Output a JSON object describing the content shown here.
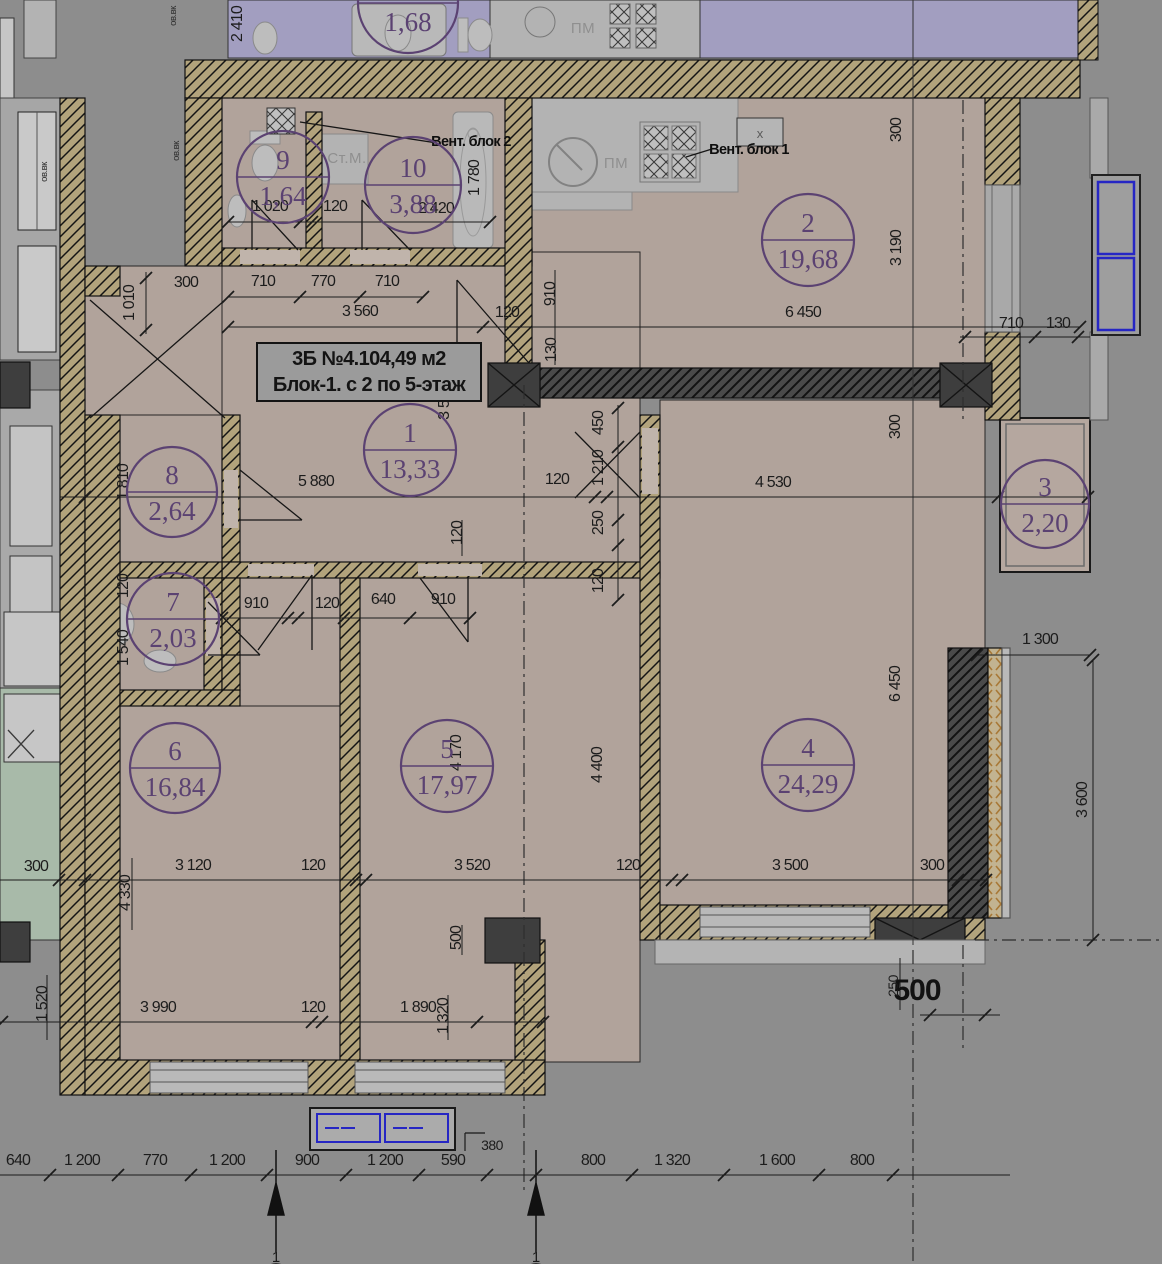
{
  "title": {
    "line1": "3Б №4.104,49 м2",
    "line2": "Блок-1. с 2 по 5-этаж"
  },
  "colors": {
    "background": "#8d8d8d",
    "floor": "#b1a39b",
    "wall_tan": "#b2a37c",
    "dark_wall": "#3e3e3e",
    "lavender": "#a29ec0",
    "kitchen_gray": "#b3b3b3",
    "green": "#a8baa9",
    "badge_purple": "#5b4272",
    "window_blue": "#2626c4",
    "insulation_orange": "#a87836"
  },
  "rooms": [
    {
      "num": "4",
      "area": "1,68",
      "cx": 408,
      "cy": 3,
      "r": 50
    },
    {
      "num": "9",
      "area": "1,64",
      "cx": 283,
      "cy": 177,
      "r": 46
    },
    {
      "num": "10",
      "area": "3,88",
      "cx": 413,
      "cy": 185,
      "r": 48
    },
    {
      "num": "2",
      "area": "19,68",
      "cx": 808,
      "cy": 240,
      "r": 46
    },
    {
      "num": "1",
      "area": "13,33",
      "cx": 410,
      "cy": 450,
      "r": 46
    },
    {
      "num": "8",
      "area": "2,64",
      "cx": 172,
      "cy": 492,
      "r": 45
    },
    {
      "num": "3",
      "area": "2,20",
      "cx": 1045,
      "cy": 504,
      "r": 44
    },
    {
      "num": "7",
      "area": "2,03",
      "cx": 173,
      "cy": 619,
      "r": 46
    },
    {
      "num": "6",
      "area": "16,84",
      "cx": 175,
      "cy": 768,
      "r": 45
    },
    {
      "num": "5",
      "area": "17,97",
      "cx": 447,
      "cy": 766,
      "r": 46
    },
    {
      "num": "4",
      "area": "24,29",
      "cx": 808,
      "cy": 765,
      "r": 46
    }
  ],
  "dims_h": [
    {
      "t": "1 020",
      "x": 270,
      "y": 211
    },
    {
      "t": "120",
      "x": 335,
      "y": 211
    },
    {
      "t": "2 420",
      "x": 436,
      "y": 213
    },
    {
      "t": "300",
      "x": 186,
      "y": 287
    },
    {
      "t": "710",
      "x": 263,
      "y": 286
    },
    {
      "t": "770",
      "x": 323,
      "y": 286
    },
    {
      "t": "710",
      "x": 387,
      "y": 286
    },
    {
      "t": "3 560",
      "x": 360,
      "y": 316
    },
    {
      "t": "120",
      "x": 507,
      "y": 317
    },
    {
      "t": "6 450",
      "x": 803,
      "y": 317
    },
    {
      "t": "710",
      "x": 1011,
      "y": 328
    },
    {
      "t": "130",
      "x": 1058,
      "y": 328
    },
    {
      "t": "5 880",
      "x": 316,
      "y": 486
    },
    {
      "t": "120",
      "x": 557,
      "y": 484
    },
    {
      "t": "4 530",
      "x": 773,
      "y": 487
    },
    {
      "t": "910",
      "x": 256,
      "y": 608
    },
    {
      "t": "120",
      "x": 327,
      "y": 608
    },
    {
      "t": "640",
      "x": 383,
      "y": 604
    },
    {
      "t": "910",
      "x": 443,
      "y": 604
    },
    {
      "t": "1 300",
      "x": 1040,
      "y": 644
    },
    {
      "t": "300",
      "x": 36,
      "y": 871
    },
    {
      "t": "3 120",
      "x": 193,
      "y": 870
    },
    {
      "t": "120",
      "x": 313,
      "y": 870
    },
    {
      "t": "3 520",
      "x": 472,
      "y": 870
    },
    {
      "t": "120",
      "x": 628,
      "y": 870
    },
    {
      "t": "3 500",
      "x": 790,
      "y": 870
    },
    {
      "t": "300",
      "x": 932,
      "y": 870
    },
    {
      "t": "3 990",
      "x": 158,
      "y": 1012
    },
    {
      "t": "120",
      "x": 313,
      "y": 1012
    },
    {
      "t": "1 890",
      "x": 418,
      "y": 1012
    },
    {
      "t": "500",
      "x": 917,
      "y": 1000,
      "cls": "dim-big"
    },
    {
      "t": "380",
      "x": 492,
      "y": 1150,
      "cls": "dim-sm"
    },
    {
      "t": "640",
      "x": 18,
      "y": 1165
    },
    {
      "t": "1 200",
      "x": 82,
      "y": 1165
    },
    {
      "t": "770",
      "x": 155,
      "y": 1165
    },
    {
      "t": "1 200",
      "x": 227,
      "y": 1165
    },
    {
      "t": "900",
      "x": 307,
      "y": 1165
    },
    {
      "t": "1 200",
      "x": 385,
      "y": 1165
    },
    {
      "t": "590",
      "x": 453,
      "y": 1165
    },
    {
      "t": "800",
      "x": 593,
      "y": 1165
    },
    {
      "t": "1 320",
      "x": 672,
      "y": 1165
    },
    {
      "t": "1 600",
      "x": 777,
      "y": 1165
    },
    {
      "t": "800",
      "x": 862,
      "y": 1165
    }
  ],
  "dims_v": [
    {
      "t": "2 410",
      "x": 242,
      "y": 24
    },
    {
      "t": "1 780",
      "x": 479,
      "y": 178
    },
    {
      "t": "300",
      "x": 901,
      "y": 130
    },
    {
      "t": "3 190",
      "x": 901,
      "y": 248
    },
    {
      "t": "1 010",
      "x": 134,
      "y": 303
    },
    {
      "t": "910",
      "x": 555,
      "y": 294
    },
    {
      "t": "130",
      "x": 556,
      "y": 350
    },
    {
      "t": "3 5",
      "x": 449,
      "y": 410
    },
    {
      "t": "450",
      "x": 603,
      "y": 423
    },
    {
      "t": "1 210",
      "x": 603,
      "y": 468
    },
    {
      "t": "250",
      "x": 603,
      "y": 523
    },
    {
      "t": "120",
      "x": 603,
      "y": 581
    },
    {
      "t": "1 810",
      "x": 128,
      "y": 482
    },
    {
      "t": "120",
      "x": 462,
      "y": 533
    },
    {
      "t": "300",
      "x": 900,
      "y": 427
    },
    {
      "t": "120",
      "x": 128,
      "y": 586
    },
    {
      "t": "1 540",
      "x": 128,
      "y": 648
    },
    {
      "t": "4 170",
      "x": 461,
      "y": 753
    },
    {
      "t": "4 400",
      "x": 602,
      "y": 765
    },
    {
      "t": "6 450",
      "x": 900,
      "y": 684
    },
    {
      "t": "3 600",
      "x": 1087,
      "y": 800
    },
    {
      "t": "4 330",
      "x": 130,
      "y": 893
    },
    {
      "t": "500",
      "x": 461,
      "y": 938
    },
    {
      "t": "1 520",
      "x": 47,
      "y": 1004
    },
    {
      "t": "1 320",
      "x": 448,
      "y": 1016
    },
    {
      "t": "250",
      "x": 898,
      "y": 986,
      "cls": "dim-sm"
    },
    {
      "t": "ов.вк",
      "x": 179,
      "y": 151,
      "cls": "tiny"
    },
    {
      "t": "ов.вк",
      "x": 47,
      "y": 172,
      "cls": "tiny"
    },
    {
      "t": "ов.вк",
      "x": 176,
      "y": 16,
      "cls": "tiny"
    }
  ],
  "labels": [
    {
      "t": "Ст.М.",
      "x": 347,
      "y": 163,
      "cls": "lbl-gray",
      "name": "washing-machine-label"
    },
    {
      "t": "ПМ",
      "x": 616,
      "y": 168,
      "cls": "lbl-gray",
      "name": "dishwasher-label"
    },
    {
      "t": "ПМ",
      "x": 583,
      "y": 33,
      "cls": "lbl-gray",
      "name": "dishwasher-label-top"
    },
    {
      "t": "Вент. блок 2",
      "x": 471,
      "y": 146,
      "cls": "lbl-dark",
      "name": "vent-block-2-label"
    },
    {
      "t": "Вент. блок 1",
      "x": 749,
      "y": 154,
      "cls": "lbl-dark",
      "name": "vent-block-1-label"
    },
    {
      "t": "x",
      "x": 760,
      "y": 138,
      "cls": "lbl-x",
      "name": "vent-shaft-mark"
    },
    {
      "t": "1",
      "x": 276,
      "y": 1262,
      "cls": "axis-num",
      "name": "axis-label-1"
    },
    {
      "t": "1",
      "x": 536,
      "y": 1262,
      "cls": "axis-num",
      "name": "axis-label-1"
    }
  ]
}
